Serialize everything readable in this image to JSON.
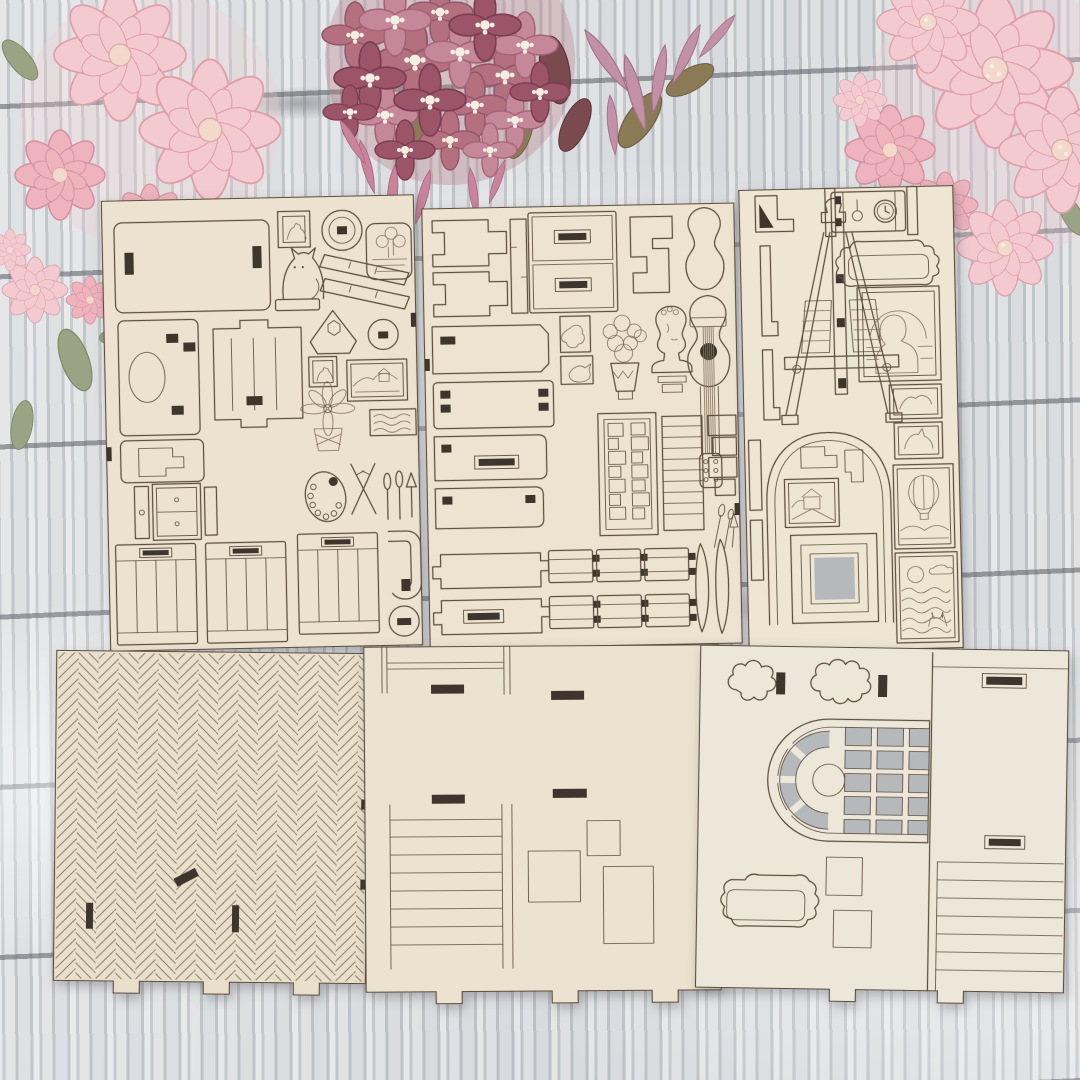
{
  "scene": {
    "type": "product-photo-laser-cut-dollhouse-kit",
    "colors": {
      "wood-light": "#d6d9db",
      "wood-mid": "#c7cbcf",
      "wood-mid2": "#cdd1d4",
      "wood-seam": "#565b62",
      "sheet-a": "#ece2cf",
      "sheet-b": "#ede3d0",
      "sheet-c": "#eee5d3",
      "sheet-d": "#e9dfca",
      "sheet-e": "#ebe3cf",
      "sheet-f": "#ede7d9",
      "line": "#5c4e3e",
      "etch": "#80705c",
      "slot": "#3e362c",
      "cutout": "#b6b9bb",
      "hbline": "#8b7f6d",
      "flower-pale": "#f4cad1",
      "flower-pale-deep": "#eeb3bd",
      "flower-stamen": "#f5efe3",
      "hydrangea-1": "#b4707f",
      "hydrangea-2": "#c5879a",
      "hydrangea-3": "#9c5568",
      "leaf-green": "#9aa383",
      "leaf-olive": "#8a7a55",
      "leaf-maroon": "#7a4a4e"
    },
    "flowers": [
      {
        "name": "pale-pink-blossoms-top-left"
      },
      {
        "name": "dusty-hydrangea-top-center"
      },
      {
        "name": "pale-pink-blossoms-top-right"
      }
    ],
    "sheets": [
      {
        "name": "parts-sheet-accessories-left",
        "pieces": [
          "wall-panel",
          "portrait-mini-frame",
          "round-mirror-frame",
          "flower-planter",
          "cat-figurine",
          "shelf-rails",
          "bed-headboard",
          "slotted-panel",
          "corner-shelf",
          "gear-disc",
          "portrait-picture",
          "landscape-picture",
          "lily-flower",
          "seascape-picture",
          "cabinet-panel",
          "nightstand",
          "paint-palette",
          "paint-brushes",
          "panel-doors",
          "curved-bracket",
          "round-disc"
        ]
      },
      {
        "name": "parts-sheet-furniture-middle",
        "pieces": [
          "joinery-brackets",
          "drawer-chest",
          "s-bracket",
          "guitar-body-blank",
          "acoustic-guitar",
          "art-plaques",
          "flower-bouquet",
          "bust-statue",
          "slotted-panels",
          "bookshelf",
          "ladder-rack",
          "joinery-blocks",
          "notched-battens",
          "curved-trims",
          "mini-brushes"
        ]
      },
      {
        "name": "parts-sheet-decor-right",
        "pieces": [
          "angle-brackets",
          "artist-easel",
          "grandfather-clock",
          "ornate-mirror-frame",
          "mona-lisa-painting",
          "small-art-frames",
          "arched-alcove-frame",
          "cottage-picture",
          "nested-square-frame",
          "hot-air-balloon-picture",
          "deer-seascape-picture"
        ]
      },
      {
        "name": "herringbone-floor-panel",
        "pieces": [
          "herringbone-parquet-etching",
          "slot-cutouts",
          "edge-tabs"
        ]
      },
      {
        "name": "staircase-wall-panel",
        "pieces": [
          "staircase-etching",
          "wainscot-rectangles",
          "slot-cutouts",
          "edge-tabs"
        ]
      },
      {
        "name": "arched-window-wall-panel",
        "pieces": [
          "ornate-cutout-pieces",
          "arched-grid-window",
          "ornate-frame-outline",
          "etched-squares",
          "side-column-ladder",
          "edge-tabs"
        ]
      }
    ]
  }
}
